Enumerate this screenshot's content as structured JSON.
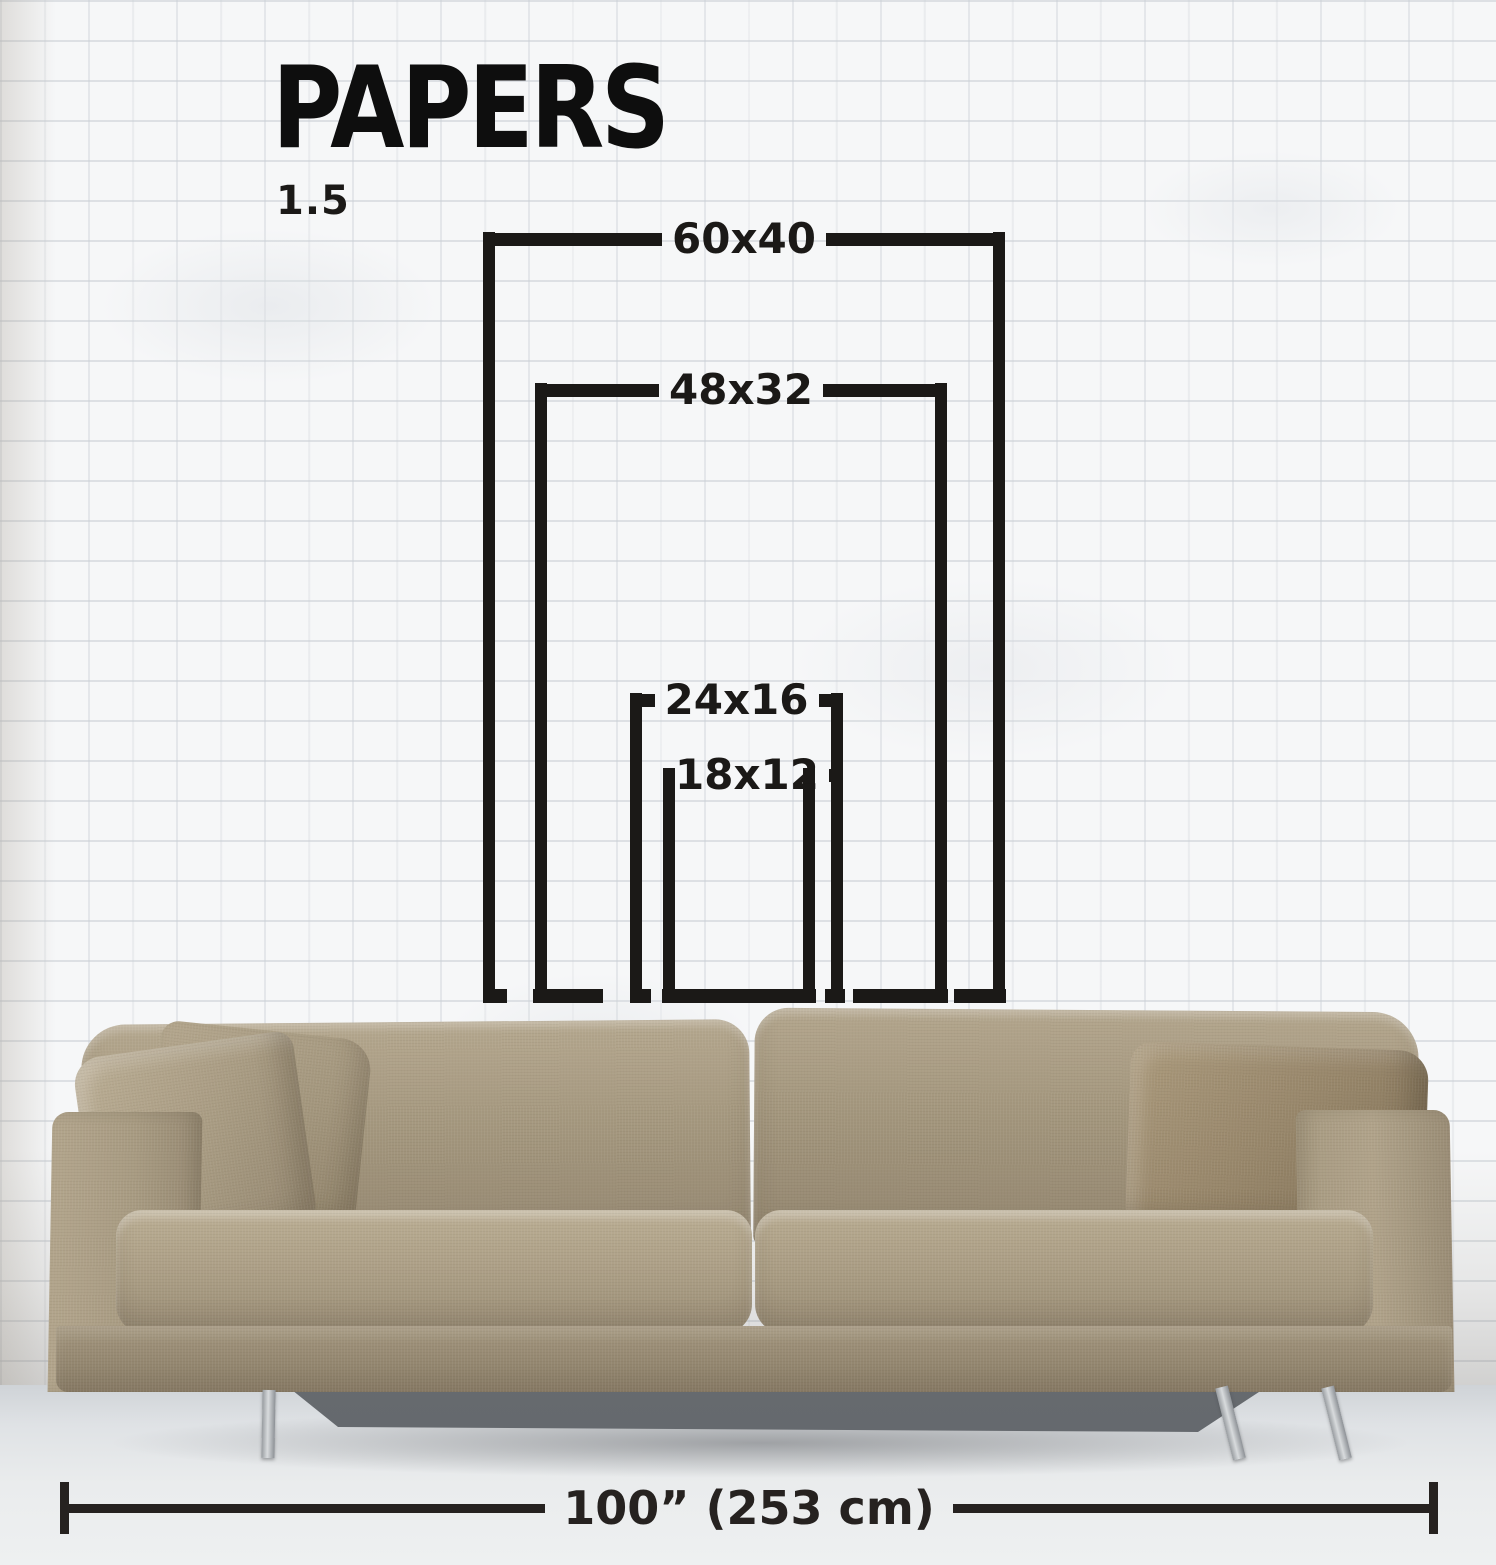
{
  "header": {
    "title": "PAPERS",
    "ratio_label": "1.5"
  },
  "size_frames": [
    {
      "label": "60x40",
      "width_in": 60,
      "height_in": 40
    },
    {
      "label": "48x32",
      "width_in": 48,
      "height_in": 32
    },
    {
      "label": "24x16",
      "width_in": 24,
      "height_in": 16
    },
    {
      "label": "18x12",
      "width_in": 18,
      "height_in": 12
    }
  ],
  "measurement": {
    "label": "100” (253 cm)"
  },
  "colors": {
    "ink": "#1b1917",
    "title_ink": "#0e0e0e",
    "wall_white": "#f6f7f8",
    "floor_grey": "#e2e5e8",
    "sofa_fabric": "#a3967e",
    "pillow_dark": "#94836a",
    "leg_chrome": "#c6c9cc"
  }
}
